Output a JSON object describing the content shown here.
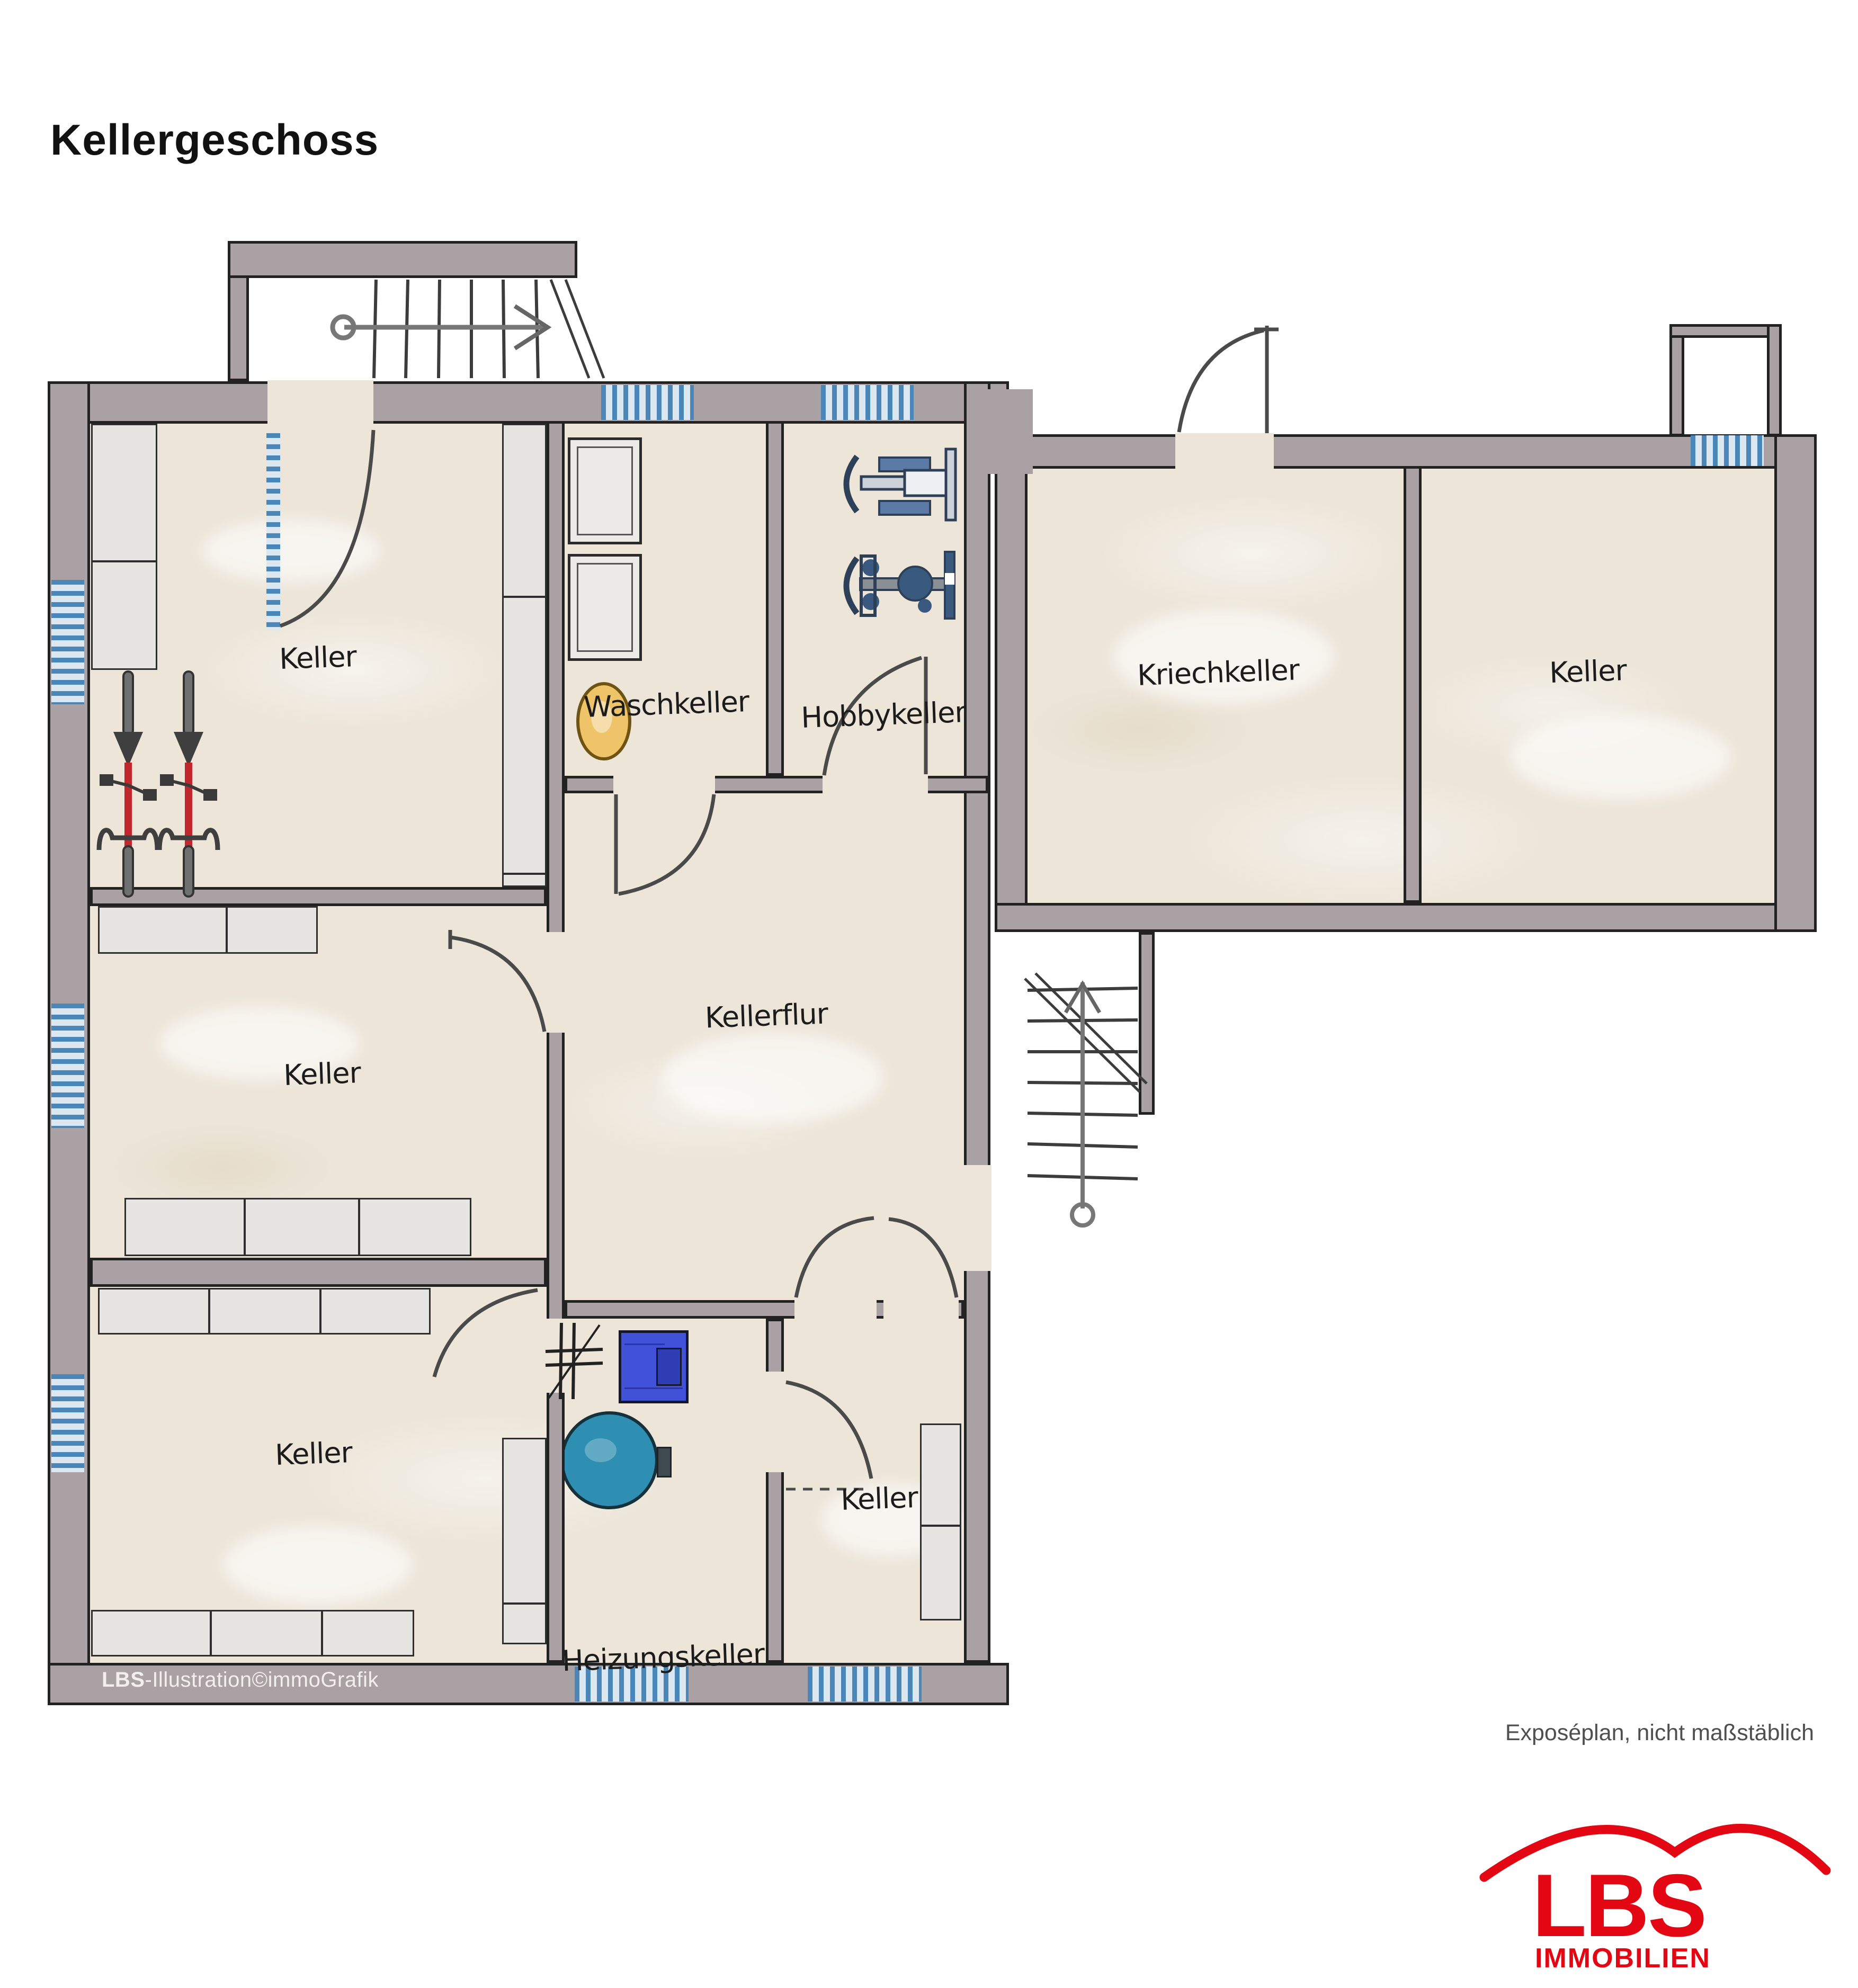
{
  "title": "Kellergeschoss",
  "rooms": [
    {
      "id": "keller-nw",
      "label": "Keller"
    },
    {
      "id": "waschkeller",
      "label": "Waschkeller"
    },
    {
      "id": "hobbykeller",
      "label": "Hobbykeller"
    },
    {
      "id": "kriechkeller",
      "label": "Kriechkeller"
    },
    {
      "id": "keller-ne",
      "label": "Keller"
    },
    {
      "id": "kellerflur",
      "label": "Kellerflur"
    },
    {
      "id": "keller-west",
      "label": "Keller"
    },
    {
      "id": "keller-sw",
      "label": "Keller"
    },
    {
      "id": "heizungskeller",
      "label": "Heizungskeller"
    },
    {
      "id": "keller-sued",
      "label": "Keller"
    }
  ],
  "watermark": {
    "brand": "LBS",
    "text": "-Illustration©immoGrafik"
  },
  "footnote": "Exposéplan, nicht maßstäblich",
  "logo": {
    "name": "LBS",
    "subtitle": "IMMOBILIEN"
  },
  "fixtures": [
    "bicycle",
    "bicycle",
    "washing-machine",
    "washing-machine",
    "laundry-basket",
    "fitness-machine",
    "fitness-machine",
    "furnace",
    "heating-tank",
    "staircase-top",
    "staircase-exterior",
    "light-shaft",
    "shelving"
  ],
  "colors": {
    "wall": "#a9a1a3",
    "floor": "#ece5d8",
    "window_blue": "#4a86b8",
    "furnace_blue": "#4152d8",
    "tank_teal": "#2f8fb2",
    "basket_yellow": "#efc368",
    "bike_red": "#c1272d",
    "logo_red": "#e30613"
  }
}
